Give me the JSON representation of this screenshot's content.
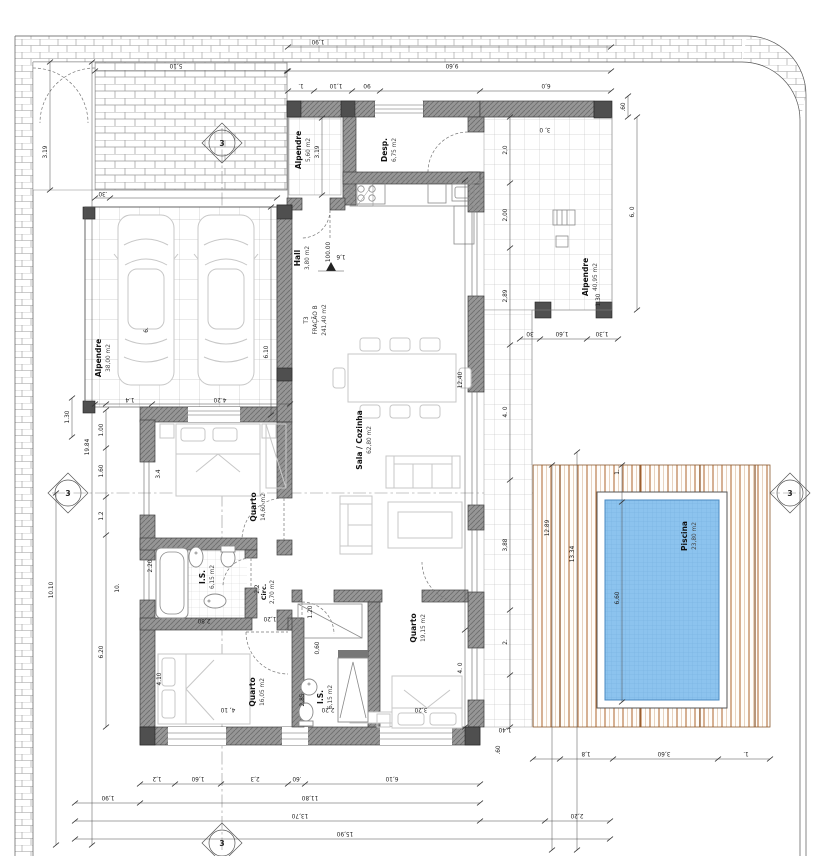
{
  "meta": {
    "drawing_type": "architectural floor plan",
    "unit_tag": "T3"
  },
  "unit": {
    "line1": "T3",
    "line2": "FRAÇÃO B",
    "line3": "241,40 m2"
  },
  "level_mark": "100.00",
  "section_marker": "3",
  "rooms": {
    "garage": {
      "name": "Alpendre",
      "area": "38,00 m2"
    },
    "porch": {
      "name": "Alpendre",
      "area": "5,60 m2"
    },
    "alp_back": {
      "name": "Alpendre",
      "area": "40,95 m2"
    },
    "desp": {
      "name": "Desp.",
      "area": "6,75 m2"
    },
    "hall": {
      "name": "Hall",
      "area": "3,80 m2"
    },
    "sala": {
      "name": "Sala / Cozinha",
      "area": "62,80 m2"
    },
    "quarto1": {
      "name": "Quarto",
      "area": "14,60 m2"
    },
    "is1": {
      "name": "I.S.",
      "area": "6,15 m2"
    },
    "circ": {
      "name": "Circ.",
      "area": "2,70 m2"
    },
    "quarto2": {
      "name": "Quarto",
      "area": "16,05 m2"
    },
    "is2": {
      "name": "I.S.",
      "area": "6,15 m2"
    },
    "quarto3": {
      "name": "Quarto",
      "area": "19,15 m2"
    },
    "piscina": {
      "name": "Piscina",
      "area": "23,80 m2"
    }
  },
  "dims": {
    "top_margin": "1,90",
    "top_total": "9,60",
    "top_seg1": "1.",
    "top_seg2": "1,10",
    "top_seg3": "90",
    "top_right": "6,0",
    "fence": "5,10",
    "alp40_inner": "3, 0",
    "alp40_col": ".60",
    "alp40_right": "6, 0",
    "alp40_v130": "1,30",
    "por_30": "30",
    "por_160": "1,60",
    "por_130": "1,30",
    "r_20": "2,0",
    "r_200": "2,00",
    "r_289": "2,89",
    "r_40": "4. 0",
    "r_388": "3,88",
    "r_2": "2.",
    "sala_h": "12,40",
    "q3_h": "4. 0",
    "l_1984": "19.84",
    "l_1010": "10.10",
    "l_319": "3.19",
    "l_10": "10.",
    "l_620": "6.20",
    "l_130": "1.30",
    "l_100": "1.00",
    "l_160": "1.60",
    "l_12": "1.2",
    "l_6": "6.",
    "g_610": "6.10",
    "g_420": "4.20",
    "g_14": "1.4",
    "g_30": ".30",
    "porch_319": "3.19",
    "hall_16": "1,6",
    "q1_34": "3.4",
    "is1_220": "2.20",
    "q2_410v": "4.10",
    "q2_410h": "4, 10",
    "q2_280": "2,80",
    "c_120": "1,20",
    "c_22": "2,2",
    "is2_120": "1.20",
    "is2_060": "0,60",
    "is2_285": "2,85",
    "is2_220": "2,20",
    "q3_320": "3,20",
    "p_1289": "12.89",
    "p_1334": "13.34",
    "p_660": "6,60",
    "p_1t": "1.",
    "p_18": "1,8",
    "p_360": "3,60",
    "p_1b": "1.",
    "p_140": "1,40",
    "p_60a": ".60",
    "b_12": "1,2",
    "b_160": "1,60",
    "b_23": "2,3",
    "b_60": ".60",
    "b_610": "6,10",
    "b_190": "1,90",
    "b_1180": "11,80",
    "b_1370": "13,70",
    "b_220": "2,20",
    "b_1590": "15,90"
  },
  "colors": {
    "wall": "#8f8f8f",
    "wall_hatch": "#6e6e6e",
    "pool_water": "#8cc3ee",
    "pool_grid": "#6fa9d9",
    "deck_board": "#b5713c",
    "tile_line": "#b8b8b8",
    "dim_line": "#4a4a4a"
  }
}
